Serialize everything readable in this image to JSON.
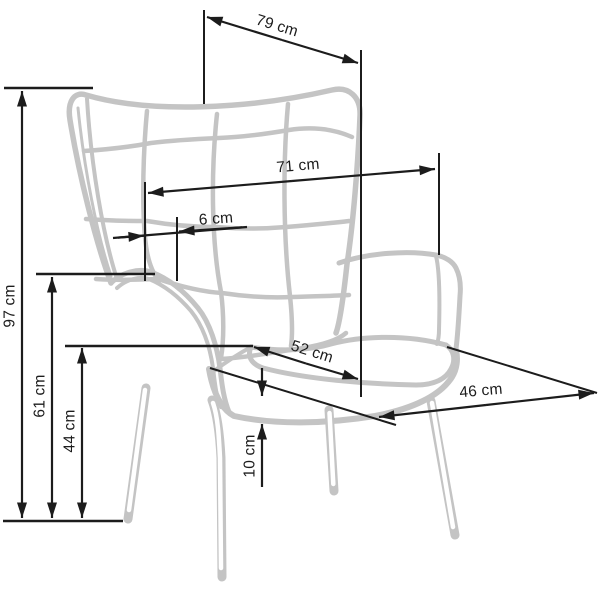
{
  "diagram": {
    "subject": "wing armchair line drawing with dimension annotations",
    "unit": "cm",
    "colors": {
      "chair_line": "#c4c4c4",
      "dimension_line": "#1c1c1c",
      "label_text": "#1c1c1c",
      "background": "#ffffff"
    },
    "dimensions": {
      "d79": {
        "text": "79 cm",
        "value": 79
      },
      "d97": {
        "text": "97 cm",
        "value": 97
      },
      "d71": {
        "text": "71 cm",
        "value": 71
      },
      "d6": {
        "text": "6 cm",
        "value": 6
      },
      "d61": {
        "text": "61 cm",
        "value": 61
      },
      "d44": {
        "text": "44 cm",
        "value": 44
      },
      "d52": {
        "text": "52 cm",
        "value": 52
      },
      "d46": {
        "text": "46 cm",
        "value": 46
      },
      "d10": {
        "text": "10 cm",
        "value": 10
      }
    }
  }
}
